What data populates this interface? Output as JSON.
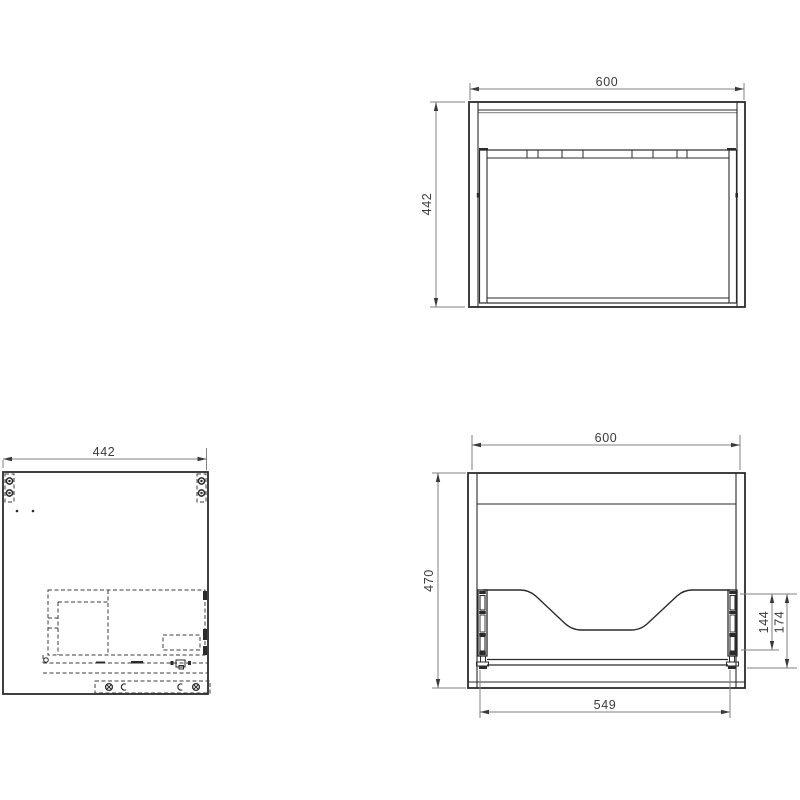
{
  "colors": {
    "object_line": "#2b2b2b",
    "hidden_line": "#3c3c3c",
    "dim_line": "#818181",
    "dim_text": "#3a3a3a",
    "background": "#ffffff"
  },
  "views": {
    "back_top": {
      "width": "600",
      "height": "442"
    },
    "side": {
      "depth": "442"
    },
    "front_bottom": {
      "width": "600",
      "height": "470",
      "inner_width": "549",
      "rail_inner": "144",
      "rail_outer": "174"
    }
  }
}
